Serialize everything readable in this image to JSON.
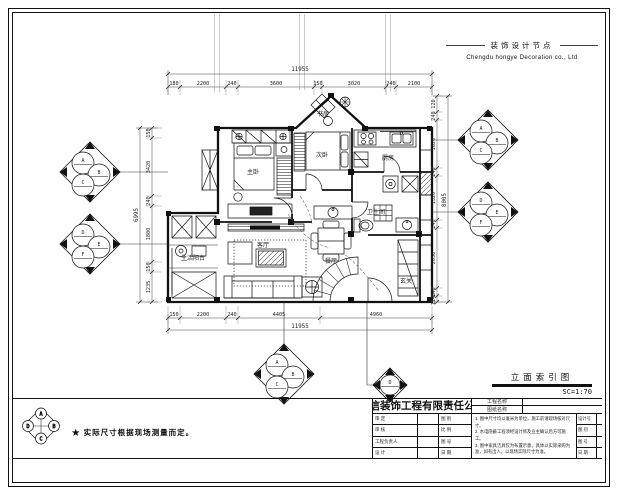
{
  "header": {
    "title_cn": "装饰设计节点",
    "company_en": "Chengdu hongye Decoration co., Ltd"
  },
  "drawing": {
    "name": "立面索引图",
    "scale": "SC=1:70"
  },
  "footnote": {
    "text": "★ 实际尺寸根据现场测量而定。"
  },
  "legend_marker": {
    "top": "A",
    "right": "B",
    "bottom": "C",
    "left": "D"
  },
  "rooms": {
    "master": "主卧",
    "bedroom2": "次卧",
    "study": "书房",
    "kitchen": "厨房",
    "bath": "卫生间",
    "living": "客厅",
    "dining": "餐厅",
    "balcony": "生活阳台",
    "entry": "玄关"
  },
  "dimensions": {
    "top": {
      "overall": "11955",
      "segs": [
        "180",
        "2200",
        "240",
        "3600",
        "150",
        "3020",
        "240",
        "2100"
      ]
    },
    "bottom": {
      "overall": "11955",
      "segs": [
        "150",
        "2200",
        "240",
        "4405",
        "4960"
      ]
    },
    "left": {
      "overall": "6995",
      "segs": [
        "150",
        "3420",
        "240",
        "1800",
        "150",
        "1235"
      ]
    },
    "right": {
      "overall": "8005",
      "segs": [
        "120",
        "240",
        "1620",
        "240",
        "1320",
        "240",
        "2050",
        "240",
        "1140"
      ]
    }
  },
  "markers": {
    "left_top": [
      "A",
      "B",
      "C"
    ],
    "left_bottom": [
      "D",
      "E",
      "F"
    ],
    "right_top": [
      "A",
      "B",
      "C"
    ],
    "right_bottom": [
      "D",
      "E",
      "F"
    ],
    "bottom_main": [
      "A",
      "B",
      "C"
    ],
    "bottom_small": [
      "D"
    ]
  },
  "title_block": {
    "company": "鸿信装饰工程有限责任公司",
    "project_label": "工程名称",
    "sheet_label": "图纸名称",
    "rows": [
      {
        "c1": "审 定",
        "c3": "图 别"
      },
      {
        "c1": "审 核",
        "c3": "比 例"
      },
      {
        "c1": "工程负责人",
        "c3": "图 号"
      },
      {
        "c1": "设 计",
        "c3": "日 期"
      }
    ],
    "notes": [
      "1. 图中尺寸均以毫米为单位，施工前请现场核对尺寸。",
      "2. 水电隐蔽工程须经设计师及业主确认后方可施工。",
      "3. 图中家具洁具仅为布置示意，具体以实际采购为准，如有出入，以现场实际尺寸为准。"
    ],
    "right_rows": [
      {
        "label": "设计号"
      },
      {
        "label": "图 别"
      },
      {
        "label": "图 号"
      },
      {
        "label": "日 期"
      }
    ]
  }
}
